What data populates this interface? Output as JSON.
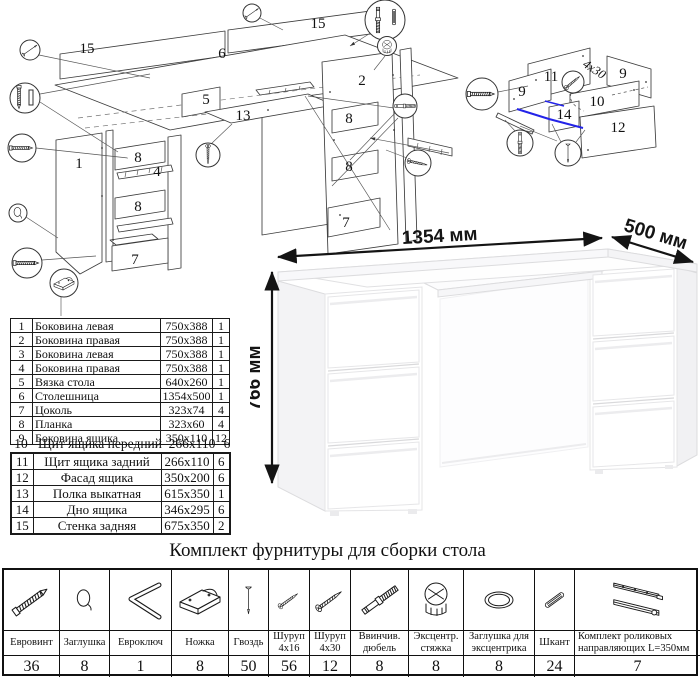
{
  "assembly_diagram": {
    "labels": [
      "15",
      "6",
      "15",
      "5",
      "13",
      "1",
      "8",
      "4",
      "8",
      "7",
      "2",
      "8",
      "8",
      "7"
    ]
  },
  "drawer_diagram": {
    "labels": [
      "11",
      "9",
      "9",
      "10",
      "14",
      "12"
    ],
    "screw_note": "4x30"
  },
  "desk": {
    "width_label": "1354 мм",
    "depth_label": "500 мм",
    "height_label": "766 мм"
  },
  "parts_table": {
    "rows": [
      {
        "num": "1",
        "name": "Боковина левая",
        "size": "750x388",
        "qty": "1"
      },
      {
        "num": "2",
        "name": "Боковина правая",
        "size": "750x388",
        "qty": "1"
      },
      {
        "num": "3",
        "name": "Боковина левая",
        "size": "750x388",
        "qty": "1"
      },
      {
        "num": "4",
        "name": "Боковина правая",
        "size": "750x388",
        "qty": "1"
      },
      {
        "num": "5",
        "name": "Вязка стола",
        "size": "640x260",
        "qty": "1"
      },
      {
        "num": "6",
        "name": "Столешница",
        "size": "1354x500",
        "qty": "1"
      },
      {
        "num": "7",
        "name": "Цоколь",
        "size": "323x74",
        "qty": "4"
      },
      {
        "num": "8",
        "name": "Планка",
        "size": "323x60",
        "qty": "4"
      },
      {
        "num": "9",
        "name": "Боковина ящика",
        "size": "350x110",
        "qty": "12"
      },
      {
        "num": "10",
        "name": "Щит ящика передний",
        "size": "266x110",
        "qty": "6"
      },
      {
        "num": "11",
        "name": "Щит ящика задний",
        "size": "266x110",
        "qty": "6"
      },
      {
        "num": "12",
        "name": "Фасад ящика",
        "size": "350x200",
        "qty": "6"
      },
      {
        "num": "13",
        "name": "Полка выкатная",
        "size": "615x350",
        "qty": "1"
      },
      {
        "num": "14",
        "name": "Дно ящика",
        "size": "346x295",
        "qty": "6"
      },
      {
        "num": "15",
        "name": "Стенка задняя",
        "size": "675x350",
        "qty": "2"
      }
    ]
  },
  "hardware": {
    "title": "Комплект фурнитуры для сборки стола",
    "items": [
      {
        "icon": "euroscrew-icon",
        "name": "Евровинт",
        "qty": "36"
      },
      {
        "icon": "cap-icon",
        "name": "Заглушка",
        "qty": "8"
      },
      {
        "icon": "hexkey-icon",
        "name": "Евроключ",
        "qty": "1"
      },
      {
        "icon": "foot-icon",
        "name": "Ножка",
        "qty": "8"
      },
      {
        "icon": "nail-icon",
        "name": "Гвоздь",
        "qty": "50"
      },
      {
        "icon": "screw-small-icon",
        "name": "Шуруп 4x16",
        "qty": "56"
      },
      {
        "icon": "screw-large-icon",
        "name": "Шуруп 4x30",
        "qty": "12"
      },
      {
        "icon": "dowel-screw-icon",
        "name": "Ввинчив. дюбель",
        "qty": "8"
      },
      {
        "icon": "cam-icon",
        "name": "Эксцентр. стяжка",
        "qty": "8"
      },
      {
        "icon": "cam-cap-icon",
        "name": "Заглушка для эксцентрика",
        "qty": "8"
      },
      {
        "icon": "shkant-icon",
        "name": "Шкант",
        "qty": "24"
      },
      {
        "icon": "slides-icon",
        "name": "Комплект роликовых направляющих L=350мм",
        "qty": "7"
      }
    ]
  },
  "colors": {
    "highlight_blue": "#2323e8",
    "line": "#3c3c3c"
  }
}
